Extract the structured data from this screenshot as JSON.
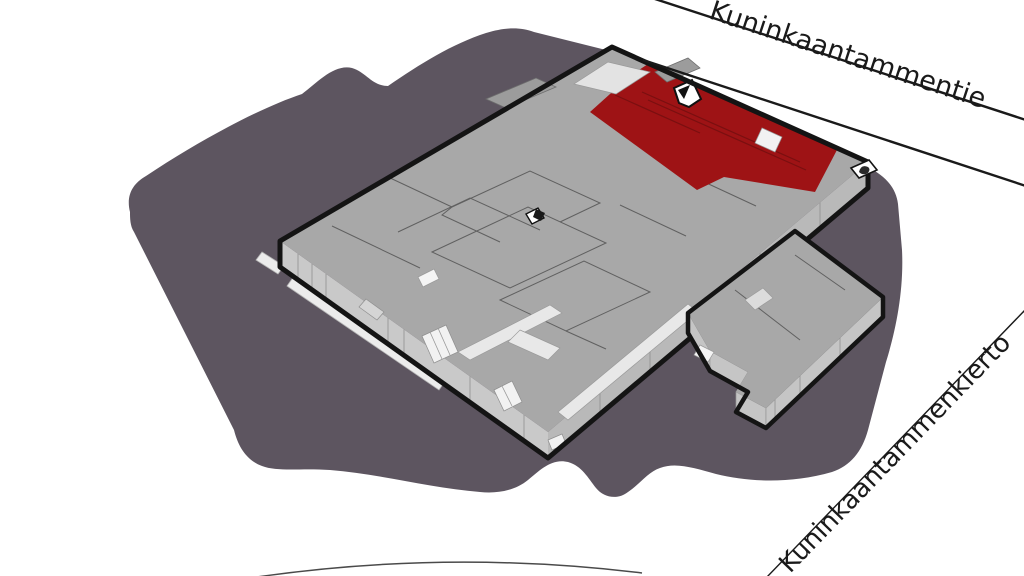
{
  "map": {
    "type": "axonometric-site-plan",
    "streets": {
      "top": {
        "label": "Kuninkaantammentie"
      },
      "bottom": {
        "label": "Kuninkaantammenkierto"
      }
    },
    "icons": [
      "entrance-marker-icon",
      "corner-entrance-icon",
      "stair-icon"
    ],
    "colors": {
      "ground": "#5d5560",
      "building_top": "#a8a8a8",
      "building_side_left": "#c9c9c9",
      "building_side_right": "#b9b9b9",
      "annex_side": "#c5c5c5",
      "highlight": "#9e1315",
      "highlight_line": "#7a0f10",
      "walkway": "#ececec",
      "corridor": "#e8e8e8",
      "canopy": "#9c9c9c",
      "outline": "#141414",
      "road_line": "#1a1a1a",
      "label_text": "#1a1a1a"
    }
  }
}
